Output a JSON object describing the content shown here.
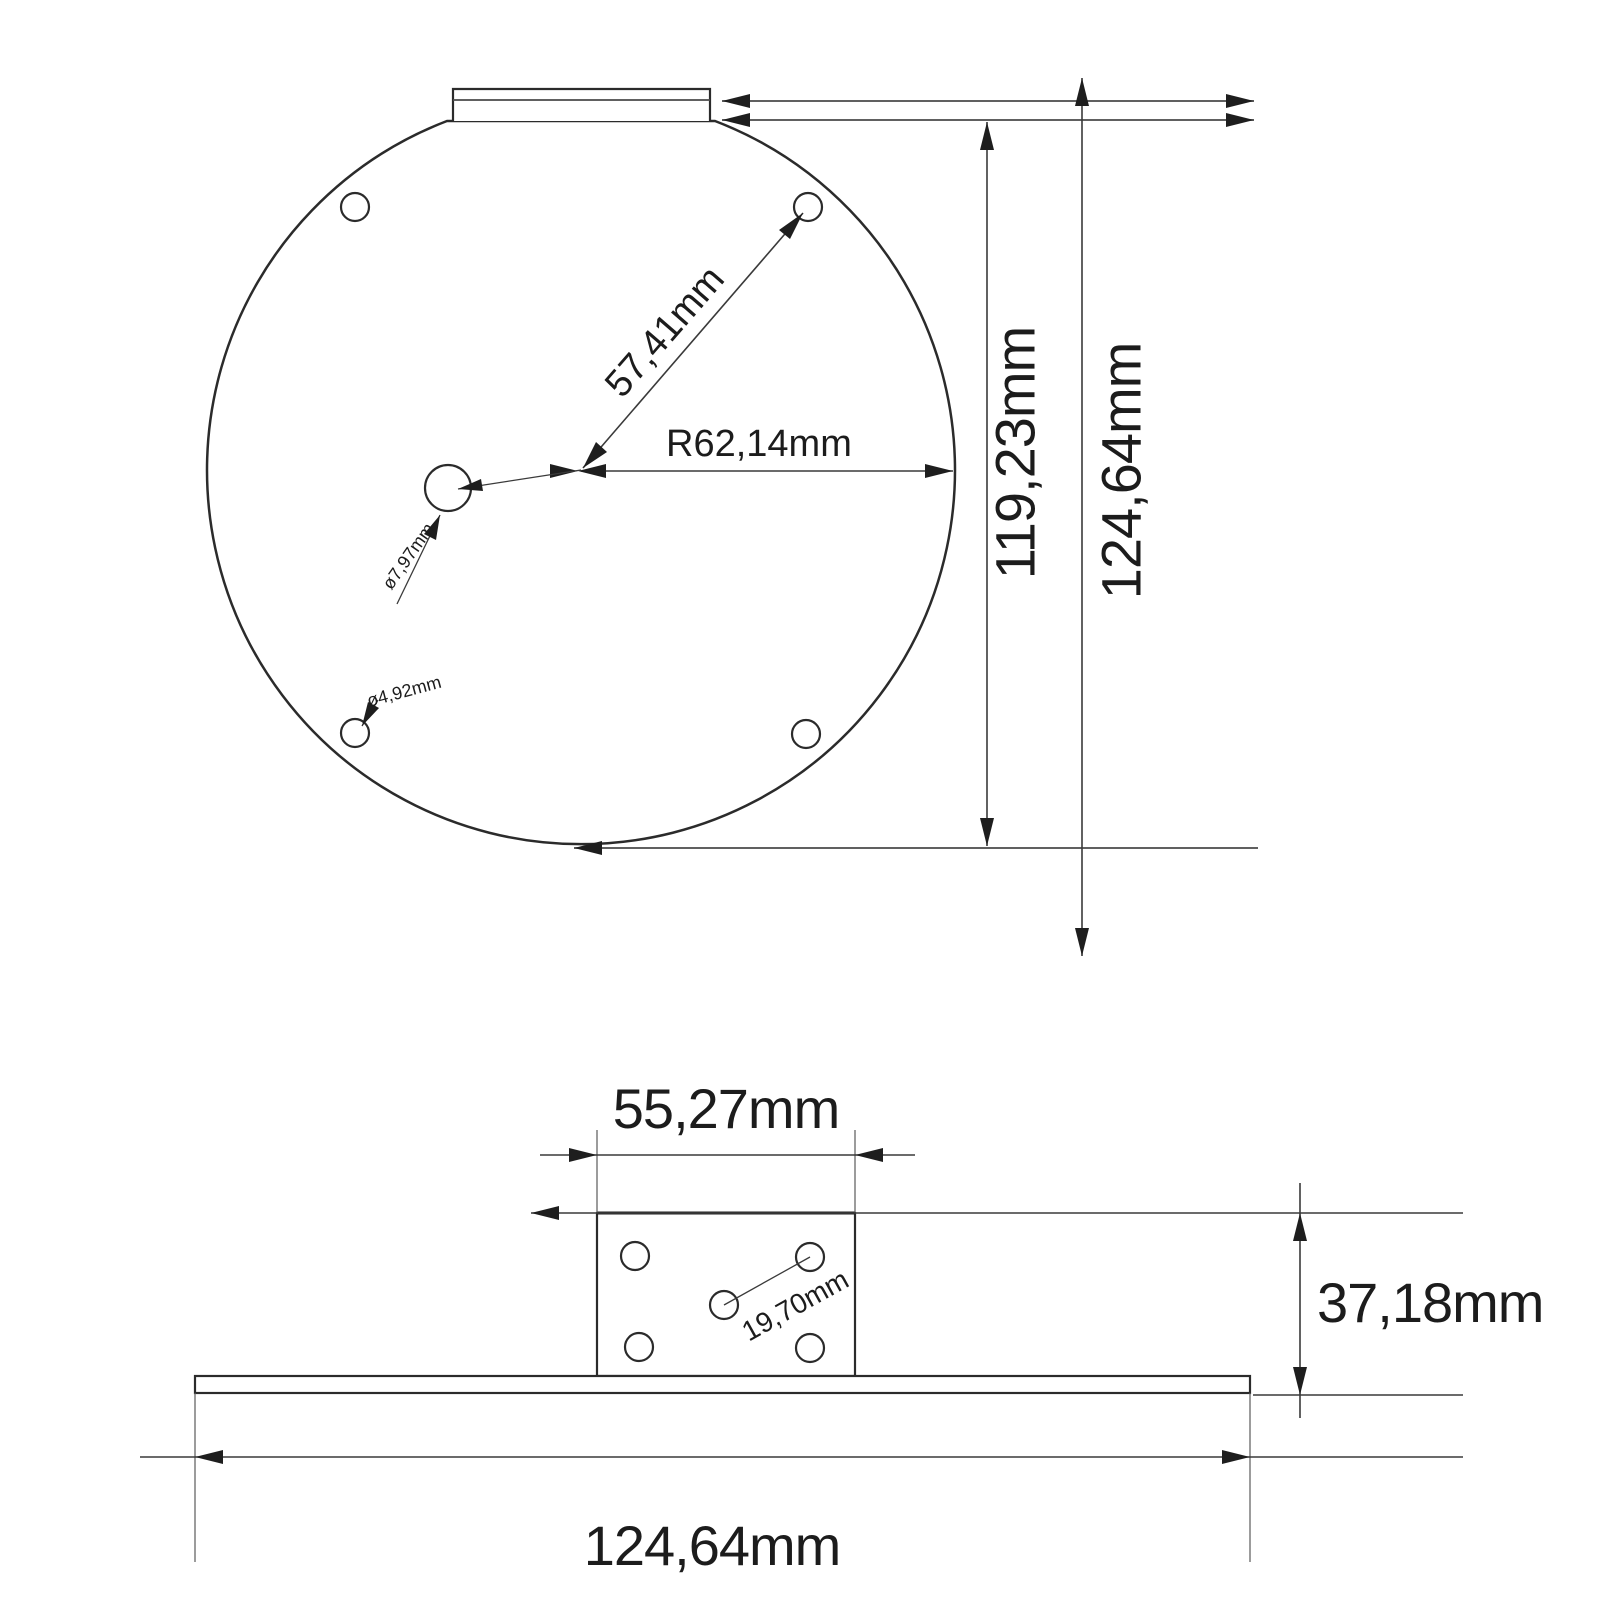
{
  "drawing": {
    "top_view": {
      "hole_distance_label": "57,41mm",
      "radius_label": "R62,14mm",
      "center_hole_diameter_label": "ø7,97mm",
      "corner_hole_diameter_label": "ø4,92mm",
      "inner_height_label": "119,23mm",
      "overall_height_label": "124,64mm"
    },
    "side_view": {
      "block_width_label": "55,27mm",
      "block_hole_spacing_label": "19,70mm",
      "block_height_label": "37,18mm",
      "base_width_label": "124,64mm"
    },
    "colors": {
      "line": "#2b2b2b",
      "text": "#1c1c1c",
      "background": "#ffffff"
    }
  }
}
